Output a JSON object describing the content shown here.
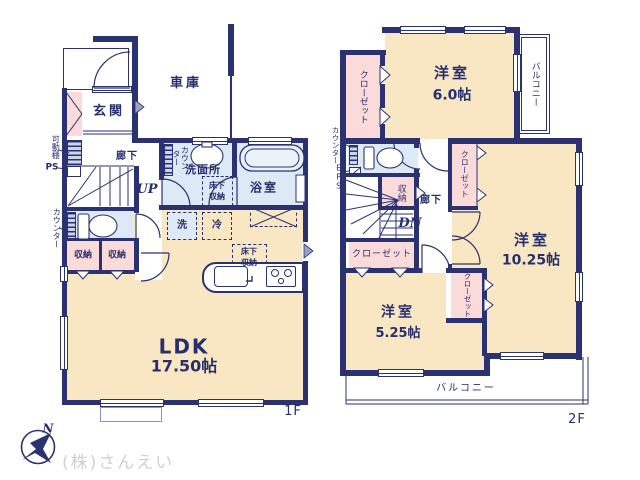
{
  "colors": {
    "wall_navy": "#2a3272",
    "text_navy": "#272f6e",
    "room_beige": "#f8e7c2",
    "closet_pink": "#fbdbda",
    "wet_blue": "#dde9f4",
    "door_grey": "#9aa2c2",
    "watermark_grey": "#d0d0d0"
  },
  "floor1": {
    "floor_label": "1F",
    "garage": "車庫",
    "entrance": "玄関",
    "hallway": "廊下",
    "stairs_up": "UP",
    "movable_shelf": "可動棚",
    "pipe_space": "PS",
    "toilet_counter": "カウンター",
    "storage_a": "収納",
    "storage_b": "収納",
    "washroom": "洗面所",
    "washroom_counter": "カウンター",
    "underfloor_front_l1": "床下",
    "underfloor_front_l2": "収納",
    "bath": "浴室",
    "washer": "洗",
    "fridge": "冷",
    "underfloor_kitchen_l1": "床下",
    "underfloor_kitchen_l2": "収納",
    "ldk_name": "LDK",
    "ldk_size": "17.50帖"
  },
  "floor2": {
    "floor_label": "2F",
    "room_6_name": "洋室",
    "room_6_size": "6.0帖",
    "balcony_east": "バルコニー",
    "closet_northwest": "クローゼット",
    "counter": "カウンター",
    "eps": "EPS",
    "storage": "収納",
    "hallway": "廊下",
    "stairs_dn": "DN",
    "closet_west": "クローゼット",
    "closet_east": "クローゼット",
    "closet_middle": "クローゼット",
    "room_525_name": "洋室",
    "room_525_size": "5.25帖",
    "room_1025_name": "洋室",
    "room_1025_size": "10.25帖",
    "balcony_south": "バルコニー"
  },
  "compass": {
    "north_label": "N"
  },
  "watermark": "(株)さんえい"
}
